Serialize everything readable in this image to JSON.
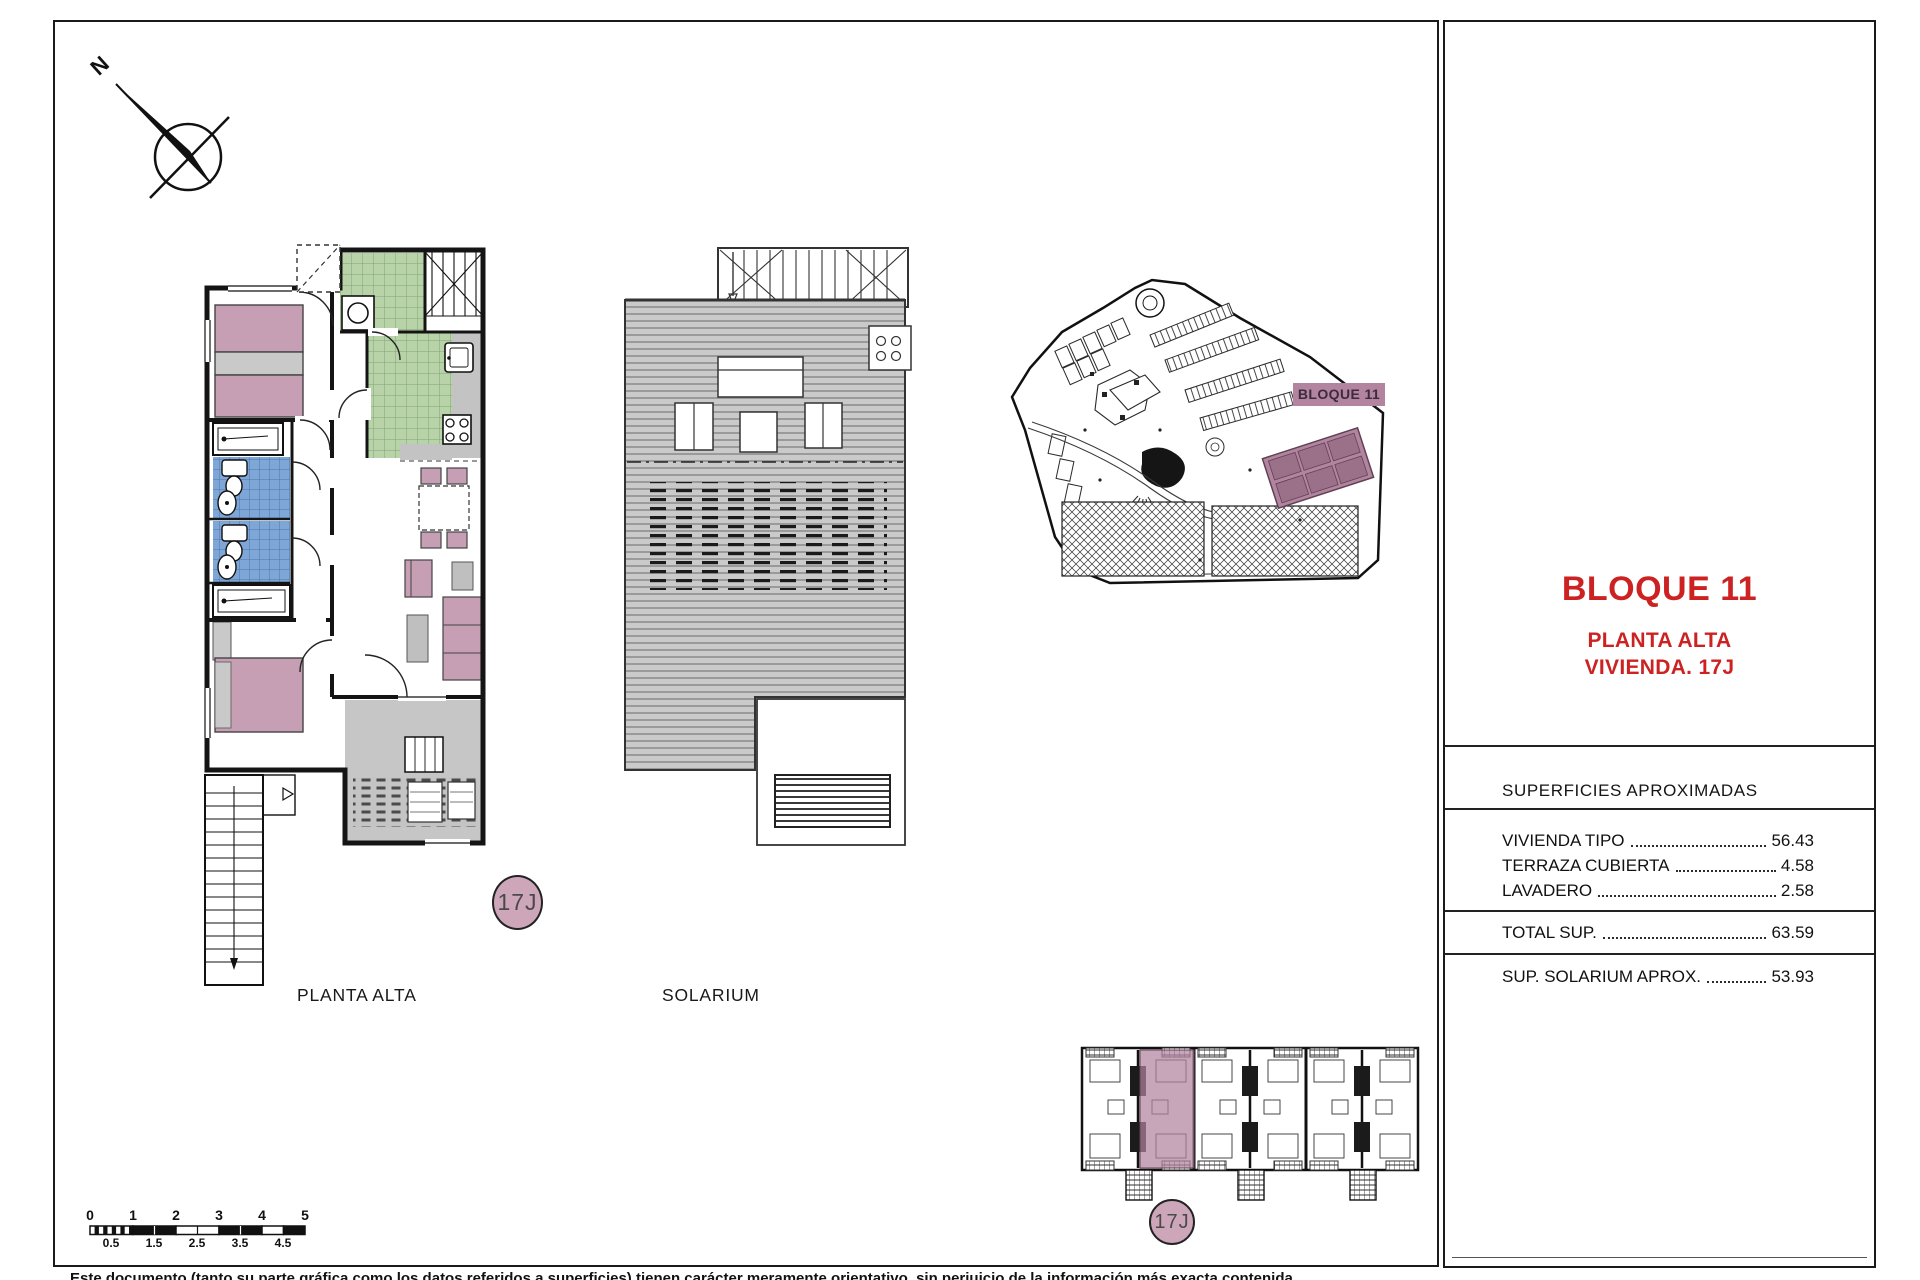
{
  "labels": {
    "north": "N",
    "floor_plan": "PLANTA ALTA",
    "solarium": "SOLARIUM",
    "unit_badge": "17J",
    "unit_badge_bottom": "17J",
    "site_block": "BLOQUE 11"
  },
  "panel": {
    "title": "BLOQUE 11",
    "subtitle1": "PLANTA ALTA",
    "subtitle2": "VIVIENDA. 17J",
    "table_header": "SUPERFICIES APROXIMADAS",
    "rows": [
      {
        "label": "VIVIENDA TIPO",
        "value": "56.43"
      },
      {
        "label": "TERRAZA CUBIERTA",
        "value": "4.58"
      },
      {
        "label": "LAVADERO",
        "value": "2.58"
      }
    ],
    "total_row": {
      "label": "TOTAL SUP.",
      "value": "63.59"
    },
    "solarium_row": {
      "label": "SUP. SOLARIUM APROX.",
      "value": "53.93"
    }
  },
  "scale_bar": {
    "top_ticks": [
      "0",
      "1",
      "2",
      "3",
      "4",
      "5"
    ],
    "bottom_ticks": [
      "0.5",
      "1.5",
      "2.5",
      "3.5",
      "4.5"
    ]
  },
  "footer": "Este documento (tanto su parte gráfica como los datos referidos a superficies) tienen carácter meramente orientativo, sin perjuicio de la información más exacta contenida",
  "colors": {
    "accent_red": "#cc2222",
    "furniture_pink": "#c79fb4",
    "badge_pink": "#cda6ba",
    "site_block_pink": "#b3849f",
    "tile_green": "#b9d3a9",
    "tile_blue": "#7ea7d8",
    "deck_gray": "#cacaca",
    "terrace_gray": "#c6c6c6",
    "wall_black": "#141414"
  }
}
